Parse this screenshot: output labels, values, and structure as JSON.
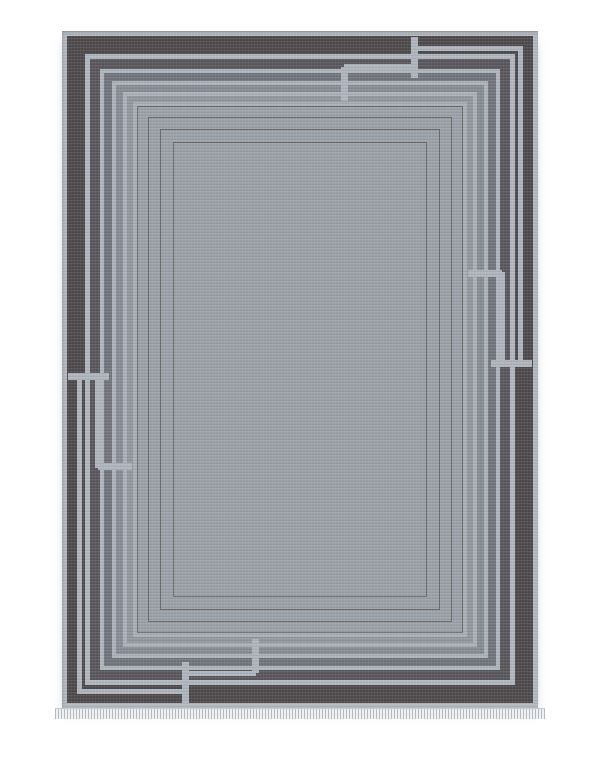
{
  "image": {
    "type": "product-photo",
    "subject": "gray area rug with art-deco interlocking line border",
    "background_color": "#ffffff"
  },
  "rug": {
    "left": 62,
    "top": 31,
    "width": 476,
    "height": 677,
    "field_color": "#9ba0a8",
    "bands": [
      {
        "name": "outer-edge",
        "width": 5,
        "color": "#b3b8c0"
      },
      {
        "name": "charcoal-band",
        "width": 18,
        "color": "#4e4a4b"
      },
      {
        "name": "light-line-1",
        "width": 5,
        "color": "#b0b6be"
      },
      {
        "name": "dark-gray-band",
        "width": 10,
        "color": "#5a575c"
      },
      {
        "name": "light-line-2",
        "width": 4,
        "color": "#aeb4bc"
      },
      {
        "name": "slate-gray-band",
        "width": 8,
        "color": "#71747b"
      },
      {
        "name": "light-line-3",
        "width": 4,
        "color": "#acb2ba"
      },
      {
        "name": "mid-gray-band",
        "width": 7,
        "color": "#878b93"
      },
      {
        "name": "light-line-4",
        "width": 4,
        "color": "#aab0b8"
      },
      {
        "name": "soft-gray-band",
        "width": 6,
        "color": "#92969d"
      },
      {
        "name": "light-line-5",
        "width": 4,
        "color": "#a8aeb6"
      }
    ],
    "pinstripes": {
      "color": "#6d6866",
      "thickness": 1.5,
      "insets": [
        75,
        86,
        98,
        111
      ]
    },
    "breaks": {
      "bar_color": "#aeb4bc",
      "bars": [
        {
          "name": "top-outer-break",
          "x": 349,
          "y": 6,
          "w": 7,
          "h": 41
        },
        {
          "name": "top-inner-break",
          "x": 279,
          "y": 36,
          "w": 7,
          "h": 34
        },
        {
          "name": "bottom-outer-break",
          "x": 120,
          "y": 631,
          "w": 7,
          "h": 41
        },
        {
          "name": "bottom-inner-break",
          "x": 190,
          "y": 608,
          "w": 7,
          "h": 34
        },
        {
          "name": "left-outer-break",
          "x": 6,
          "y": 342,
          "w": 41,
          "h": 7
        },
        {
          "name": "left-inner-break",
          "x": 36,
          "y": 432,
          "w": 34,
          "h": 7
        },
        {
          "name": "right-outer-break",
          "x": 429,
          "y": 329,
          "w": 41,
          "h": 7
        },
        {
          "name": "right-inner-break",
          "x": 406,
          "y": 239,
          "w": 34,
          "h": 7
        }
      ],
      "offset_lines": [
        {
          "name": "top-inner-offset-line",
          "x": 282,
          "y": 33,
          "w": 70,
          "h": 5
        },
        {
          "name": "bottom-inner-offset-line",
          "x": 124,
          "y": 640,
          "w": 70,
          "h": 5
        },
        {
          "name": "left-inner-offset-line",
          "x": 33,
          "y": 345,
          "w": 5,
          "h": 92
        },
        {
          "name": "right-inner-offset-line",
          "x": 438,
          "y": 241,
          "w": 5,
          "h": 92
        },
        {
          "name": "top-edge-offset-line",
          "x": 352,
          "y": 15,
          "w": 109,
          "h": 5
        },
        {
          "name": "right-edge-offset-line",
          "x": 456,
          "y": 15,
          "w": 5,
          "h": 319
        },
        {
          "name": "bottom-edge-offset-line",
          "x": 15,
          "y": 658,
          "w": 109,
          "h": 5
        },
        {
          "name": "left-edge-offset-line",
          "x": 15,
          "y": 344,
          "w": 5,
          "h": 319
        }
      ]
    },
    "fringe": {
      "height": 10,
      "overhang": 7,
      "tick_color": "#b6bbc2",
      "gap_color": "#eef0f3"
    }
  }
}
